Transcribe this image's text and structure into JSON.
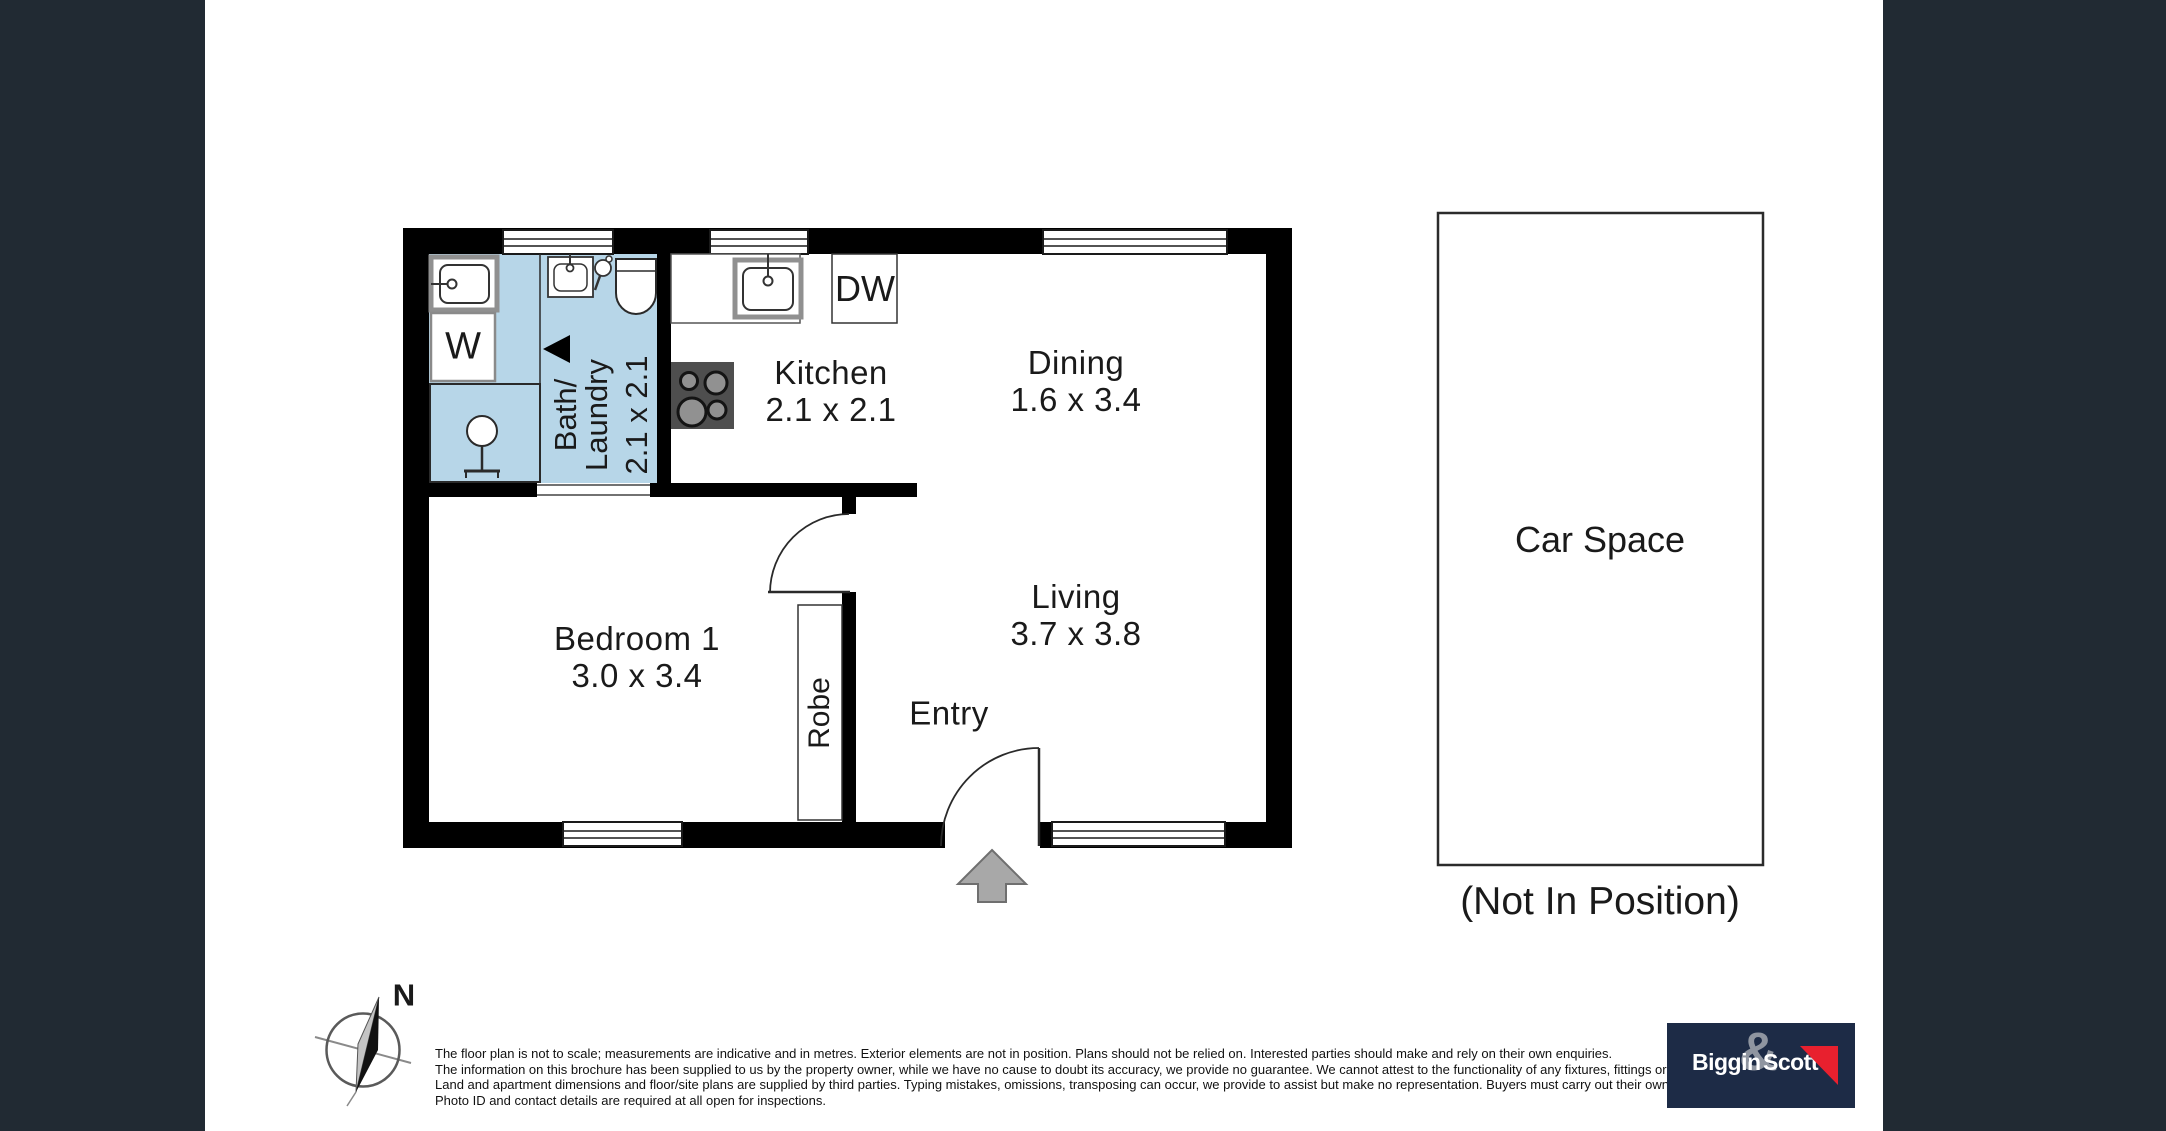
{
  "page": {
    "sidebar_color": "#212a33",
    "background": "#ffffff",
    "wall_color": "#000000",
    "wet_area_fill": "#b7d6e8",
    "entry_arrow_color": "#a8a8a8"
  },
  "rooms": {
    "bath": {
      "name_line1": "Bath/",
      "name_line2": "Laundry",
      "dims": "2.1 x 2.1"
    },
    "kitchen": {
      "name": "Kitchen",
      "dims": "2.1 x 2.1"
    },
    "dining": {
      "name": "Dining",
      "dims": "1.6 x 3.4"
    },
    "bedroom": {
      "name": "Bedroom 1",
      "dims": "3.0 x 3.4"
    },
    "living": {
      "name": "Living",
      "dims": "3.7 x 3.8"
    },
    "entry": {
      "name": "Entry"
    }
  },
  "fixtures": {
    "washer_label": "W",
    "dishwasher_label": "DW",
    "robe_label": "Robe"
  },
  "carspace": {
    "label": "Car Space",
    "note": "(Not In Position)"
  },
  "compass": {
    "north_label": "N"
  },
  "disclaimer": {
    "lines": [
      "The floor plan is not to scale; measurements are indicative and in metres. Exterior elements are not in position. Plans should not be relied on. Interested parties should make and rely on their own enquiries.",
      "The information on this brochure has been supplied to us by the property owner, while we have no cause to doubt its accuracy, we provide no guarantee. We cannot attest to the functionality of any fixtures, fittings or inclusions to the property.",
      "Land and apartment dimensions and floor/site plans are supplied by third parties. Typing mistakes, omissions, transposing can occur, we provide to assist but make no representation. Buyers must carry out their own due diligence.",
      "Photo ID and contact details are required at all open for inspections."
    ]
  },
  "logo": {
    "part1": "Biggin",
    "amp": "&",
    "part2": "Scott",
    "bg_color": "#1d2b46",
    "accent_color": "#e8202e"
  }
}
